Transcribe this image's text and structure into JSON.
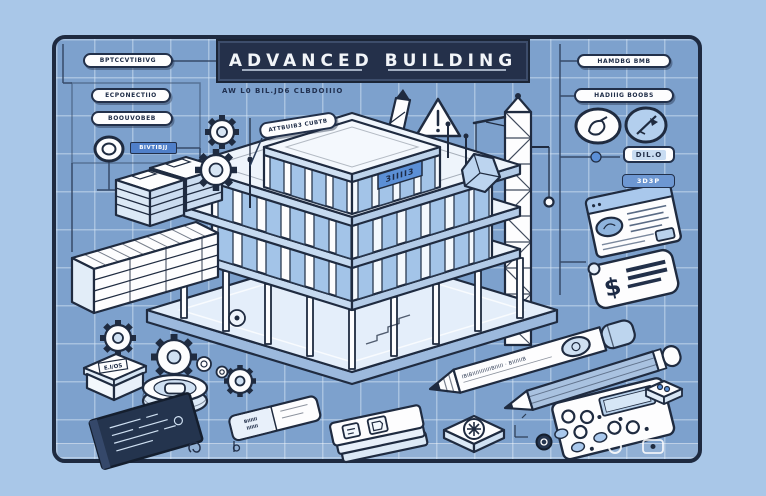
{
  "banner": {
    "title": "ADVANCED BUILDING",
    "subtitle": "AW L0 BIL.JD6 CLBDOIIIO"
  },
  "labels": {
    "left_pills": [
      {
        "label": "BPTCCVTIBIVG"
      },
      {
        "label": "ECPONECTIIO"
      },
      {
        "label": "BOOUVOBEB"
      }
    ],
    "left_chip": "BIVTIBJJ",
    "building_tag": "ATTBUIB3 CUBTB",
    "building_sign": "3IIII3",
    "right_pills": [
      {
        "label": "HAMDBG BMB"
      },
      {
        "label": "HADIIIG BOOBS"
      }
    ],
    "chip_dilo": "DIL.O",
    "chip_3d3p": "3D3P",
    "box_label": "E.I/OS",
    "pen_text": "IBIBIIIIIIIIIIIBIIIII · BIIIIIIB",
    "eraser_line1": "BIIIIII",
    "eraser_line2": "IIIIIII",
    "tag_symbol": "$"
  },
  "colors": {
    "outer_bg": "#a9c7e8",
    "panel_bg": "#7da1cd",
    "panel_border": "#1e2a40",
    "grid_line": "#dbe9f7",
    "banner_bg": "#24304a",
    "ink": "#1f2b40",
    "white_fill": "#fdfdfe",
    "window_blue": "#a3c4e8",
    "accent_blue": "#5b8fd6",
    "chip_blue": "#4f7fc9",
    "tablet_navy": "#24344e"
  }
}
